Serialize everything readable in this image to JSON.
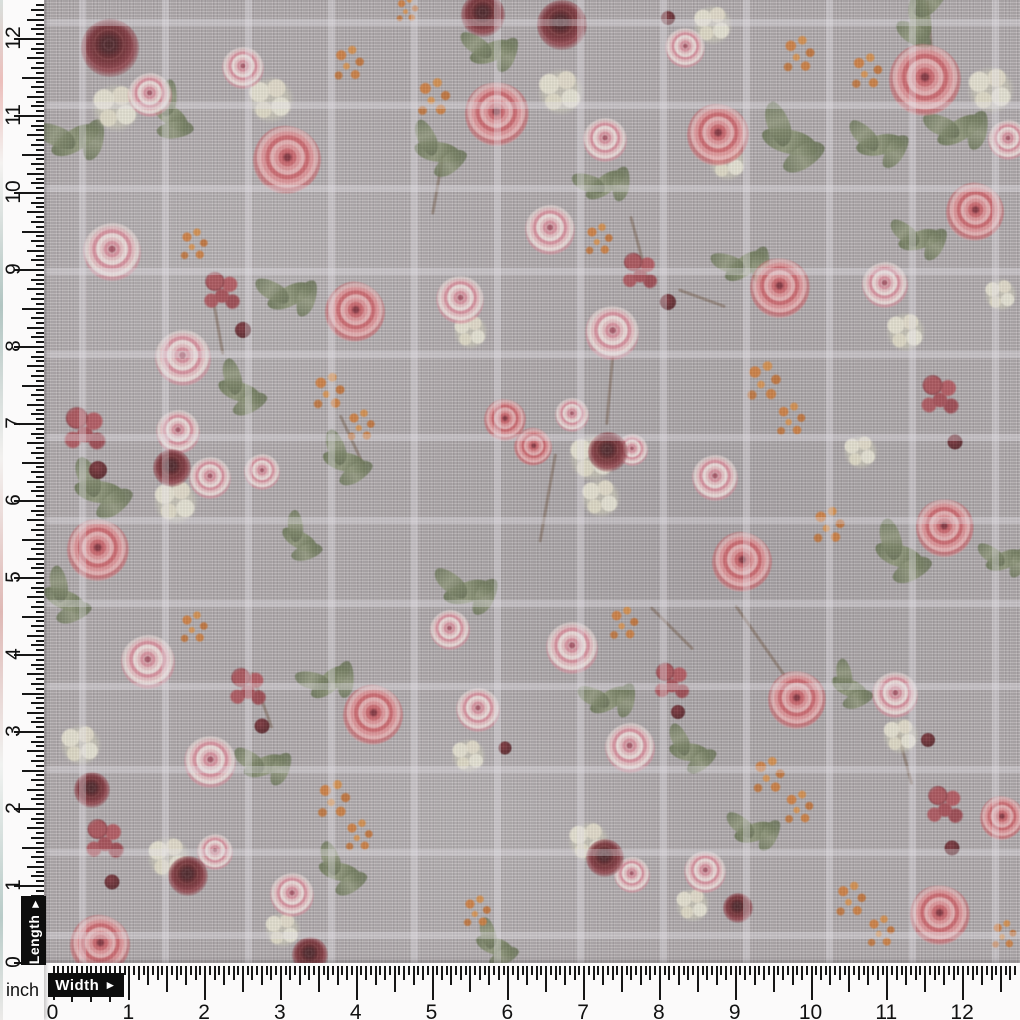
{
  "photo": {
    "description": "Grey linen fabric with coral-pink rose floral print and white windowpane check, photographed with inch measurement rulers",
    "fabric_base_color": "#b2acae",
    "check_line_color": "#ece9ef",
    "check_spacing_px": 83
  },
  "left_ruler": {
    "label": "Length",
    "arrow": "►",
    "numbers": [
      "0",
      "1",
      "2",
      "3",
      "4",
      "5",
      "6",
      "7",
      "8",
      "9",
      "10",
      "11",
      "12"
    ],
    "zero_px": 962,
    "inch_px": 77
  },
  "bottom_ruler": {
    "label": "Width",
    "arrow": "►",
    "numbers": [
      "0",
      "1",
      "2",
      "3",
      "4",
      "5",
      "6",
      "7",
      "8",
      "9",
      "10",
      "11",
      "12"
    ],
    "zero_px": 52.5,
    "inch_px": 75.8
  },
  "corner": {
    "unit_label": "inch"
  },
  "palette": {
    "rose_coral": "#d95f68",
    "rose_pink": "#e59aa6",
    "rose_maroon": "#6d1820",
    "cream_flower": "#ece7d2",
    "orange_flower": "#d97b2e",
    "berry": "#b8474f",
    "leaf": "#75815c",
    "dark_berry": "#5e1720",
    "ruler_bg": "#fbfafa",
    "ruler_ink": "#161616",
    "label_box": "#0d0d0d"
  },
  "flowers": [
    [
      "S",
      640,
      250,
      70,
      75
    ],
    [
      "S",
      218,
      325,
      60,
      80
    ],
    [
      "S",
      262,
      700,
      60,
      70
    ],
    [
      "S",
      760,
      640,
      85,
      55
    ],
    [
      "S",
      548,
      498,
      90,
      100
    ],
    [
      "S",
      672,
      628,
      60,
      45
    ],
    [
      "S",
      702,
      298,
      50,
      20
    ],
    [
      "S",
      930,
      28,
      55,
      85
    ],
    [
      "S",
      352,
      440,
      55,
      65
    ],
    [
      "S",
      905,
      758,
      55,
      75
    ],
    [
      "S",
      438,
      185,
      60,
      100
    ],
    [
      "S",
      610,
      390,
      70,
      95
    ],
    [
      "L",
      75,
      140,
      52,
      -30
    ],
    [
      "L",
      170,
      115,
      46,
      40
    ],
    [
      "L",
      438,
      152,
      48,
      10
    ],
    [
      "L",
      492,
      52,
      46,
      -20
    ],
    [
      "L",
      790,
      142,
      58,
      15
    ],
    [
      "L",
      880,
      145,
      48,
      -10
    ],
    [
      "L",
      920,
      18,
      50,
      80
    ],
    [
      "L",
      960,
      130,
      50,
      -30
    ],
    [
      "L",
      290,
      296,
      48,
      -25
    ],
    [
      "L",
      240,
      392,
      46,
      20
    ],
    [
      "L",
      745,
      266,
      46,
      -35
    ],
    [
      "L",
      345,
      462,
      46,
      15
    ],
    [
      "L",
      468,
      592,
      50,
      -15
    ],
    [
      "L",
      65,
      600,
      46,
      25
    ],
    [
      "L",
      100,
      492,
      52,
      10
    ],
    [
      "L",
      265,
      766,
      44,
      -20
    ],
    [
      "L",
      690,
      752,
      42,
      10
    ],
    [
      "L",
      330,
      682,
      46,
      -40
    ],
    [
      "L",
      900,
      556,
      52,
      20
    ],
    [
      "L",
      340,
      872,
      44,
      15
    ],
    [
      "L",
      755,
      832,
      42,
      -15
    ],
    [
      "L",
      495,
      946,
      40,
      20
    ],
    [
      "L",
      1005,
      560,
      40,
      -20
    ],
    [
      "L",
      610,
      700,
      44,
      -30
    ],
    [
      "L",
      850,
      688,
      40,
      25
    ],
    [
      "L",
      920,
      240,
      44,
      -15
    ],
    [
      "L",
      605,
      185,
      44,
      -35
    ],
    [
      "L",
      300,
      540,
      40,
      30
    ],
    [
      "C",
      115,
      108,
      56,
      0
    ],
    [
      "C",
      270,
      100,
      54,
      0
    ],
    [
      "C",
      560,
      92,
      54,
      0
    ],
    [
      "C",
      712,
      25,
      46,
      0
    ],
    [
      "C",
      990,
      90,
      55,
      0
    ],
    [
      "C",
      905,
      332,
      46,
      0
    ],
    [
      "C",
      470,
      332,
      40,
      0
    ],
    [
      "C",
      592,
      458,
      56,
      0
    ],
    [
      "C",
      600,
      498,
      46,
      0
    ],
    [
      "C",
      175,
      502,
      52,
      0
    ],
    [
      "C",
      80,
      745,
      48,
      0
    ],
    [
      "C",
      900,
      736,
      42,
      0
    ],
    [
      "C",
      468,
      756,
      40,
      0
    ],
    [
      "C",
      168,
      858,
      50,
      0
    ],
    [
      "C",
      282,
      930,
      42,
      0
    ],
    [
      "C",
      588,
      842,
      48,
      0
    ],
    [
      "C",
      692,
      905,
      40,
      0
    ],
    [
      "C",
      860,
      452,
      40,
      0
    ],
    [
      "C",
      1000,
      295,
      38,
      0
    ],
    [
      "C",
      727,
      162,
      44,
      0
    ],
    [
      "O",
      350,
      64,
      44,
      0
    ],
    [
      "O",
      435,
      98,
      48,
      0
    ],
    [
      "O",
      408,
      10,
      32,
      0
    ],
    [
      "O",
      800,
      55,
      46,
      0
    ],
    [
      "O",
      868,
      72,
      45,
      0
    ],
    [
      "O",
      195,
      245,
      40,
      0
    ],
    [
      "O",
      600,
      240,
      40,
      0
    ],
    [
      "O",
      330,
      392,
      46,
      0
    ],
    [
      "O",
      362,
      426,
      40,
      0
    ],
    [
      "O",
      765,
      382,
      50,
      0
    ],
    [
      "O",
      792,
      420,
      42,
      0
    ],
    [
      "O",
      195,
      628,
      40,
      0
    ],
    [
      "O",
      625,
      624,
      42,
      0
    ],
    [
      "O",
      830,
      526,
      46,
      0
    ],
    [
      "O",
      335,
      800,
      48,
      0
    ],
    [
      "O",
      360,
      836,
      40,
      0
    ],
    [
      "O",
      770,
      776,
      46,
      0
    ],
    [
      "O",
      800,
      808,
      42,
      0
    ],
    [
      "O",
      852,
      900,
      44,
      0
    ],
    [
      "O",
      882,
      932,
      40,
      0
    ],
    [
      "O",
      478,
      912,
      40,
      0
    ],
    [
      "O",
      1005,
      935,
      36,
      0
    ],
    [
      "B",
      222,
      292,
      48,
      0
    ],
    [
      "B",
      85,
      430,
      55,
      0
    ],
    [
      "B",
      640,
      272,
      46,
      0
    ],
    [
      "B",
      940,
      396,
      50,
      0
    ],
    [
      "B",
      248,
      688,
      48,
      0
    ],
    [
      "B",
      672,
      682,
      46,
      0
    ],
    [
      "B",
      105,
      840,
      50,
      0
    ],
    [
      "B",
      945,
      806,
      48,
      0
    ],
    [
      "R",
      287,
      160,
      68,
      10
    ],
    [
      "R",
      497,
      114,
      64,
      -15
    ],
    [
      "R",
      718,
      135,
      62,
      5
    ],
    [
      "R",
      925,
      80,
      72,
      0
    ],
    [
      "R",
      355,
      312,
      60,
      20
    ],
    [
      "R",
      780,
      288,
      60,
      -10
    ],
    [
      "R",
      975,
      212,
      58,
      15
    ],
    [
      "R",
      505,
      420,
      42,
      0
    ],
    [
      "R",
      533,
      447,
      38,
      30
    ],
    [
      "R",
      98,
      550,
      62,
      -5
    ],
    [
      "R",
      742,
      562,
      60,
      10
    ],
    [
      "R",
      945,
      528,
      58,
      -20
    ],
    [
      "R",
      373,
      715,
      60,
      15
    ],
    [
      "R",
      797,
      700,
      58,
      -5
    ],
    [
      "R",
      100,
      945,
      60,
      10
    ],
    [
      "R",
      940,
      915,
      60,
      -10
    ],
    [
      "R",
      1002,
      818,
      44,
      0
    ],
    [
      "P",
      243,
      68,
      42,
      0
    ],
    [
      "P",
      150,
      95,
      44,
      -10
    ],
    [
      "P",
      685,
      48,
      40,
      10
    ],
    [
      "P",
      605,
      140,
      44,
      0
    ],
    [
      "P",
      112,
      252,
      58,
      0
    ],
    [
      "P",
      183,
      358,
      56,
      -10
    ],
    [
      "P",
      460,
      300,
      48,
      10
    ],
    [
      "P",
      550,
      230,
      50,
      0
    ],
    [
      "P",
      612,
      333,
      54,
      15
    ],
    [
      "P",
      885,
      285,
      46,
      -10
    ],
    [
      "P",
      715,
      478,
      46,
      0
    ],
    [
      "P",
      178,
      432,
      44,
      0
    ],
    [
      "P",
      210,
      478,
      42,
      0
    ],
    [
      "P",
      262,
      472,
      36,
      0
    ],
    [
      "P",
      572,
      415,
      34,
      0
    ],
    [
      "P",
      632,
      450,
      32,
      0
    ],
    [
      "P",
      148,
      662,
      54,
      -5
    ],
    [
      "P",
      210,
      762,
      52,
      10
    ],
    [
      "P",
      572,
      648,
      52,
      0
    ],
    [
      "P",
      630,
      748,
      50,
      -10
    ],
    [
      "P",
      895,
      695,
      46,
      10
    ],
    [
      "P",
      478,
      710,
      44,
      0
    ],
    [
      "P",
      450,
      630,
      40,
      -15
    ],
    [
      "P",
      292,
      895,
      44,
      0
    ],
    [
      "P",
      705,
      872,
      42,
      10
    ],
    [
      "P",
      215,
      852,
      36,
      0
    ],
    [
      "P",
      632,
      875,
      36,
      -10
    ],
    [
      "P",
      1008,
      140,
      40,
      0
    ],
    [
      "M",
      110,
      48,
      58,
      0
    ],
    [
      "M",
      483,
      15,
      44,
      10
    ],
    [
      "M",
      562,
      25,
      50,
      -10
    ],
    [
      "M",
      172,
      468,
      38,
      0
    ],
    [
      "M",
      608,
      452,
      40,
      0
    ],
    [
      "M",
      92,
      790,
      36,
      0
    ],
    [
      "M",
      188,
      876,
      40,
      0
    ],
    [
      "M",
      310,
      955,
      36,
      0
    ],
    [
      "M",
      605,
      858,
      38,
      0
    ],
    [
      "M",
      738,
      908,
      30,
      0
    ],
    [
      "D",
      243,
      330,
      16,
      0
    ],
    [
      "D",
      668,
      302,
      16,
      0
    ],
    [
      "D",
      98,
      470,
      18,
      0
    ],
    [
      "D",
      262,
      726,
      15,
      0
    ],
    [
      "D",
      678,
      712,
      14,
      0
    ],
    [
      "D",
      955,
      442,
      15,
      0
    ],
    [
      "D",
      112,
      882,
      15,
      0
    ],
    [
      "D",
      928,
      740,
      14,
      0
    ],
    [
      "D",
      952,
      848,
      15,
      0
    ],
    [
      "D",
      505,
      748,
      13,
      0
    ],
    [
      "D",
      668,
      18,
      14,
      0
    ]
  ]
}
